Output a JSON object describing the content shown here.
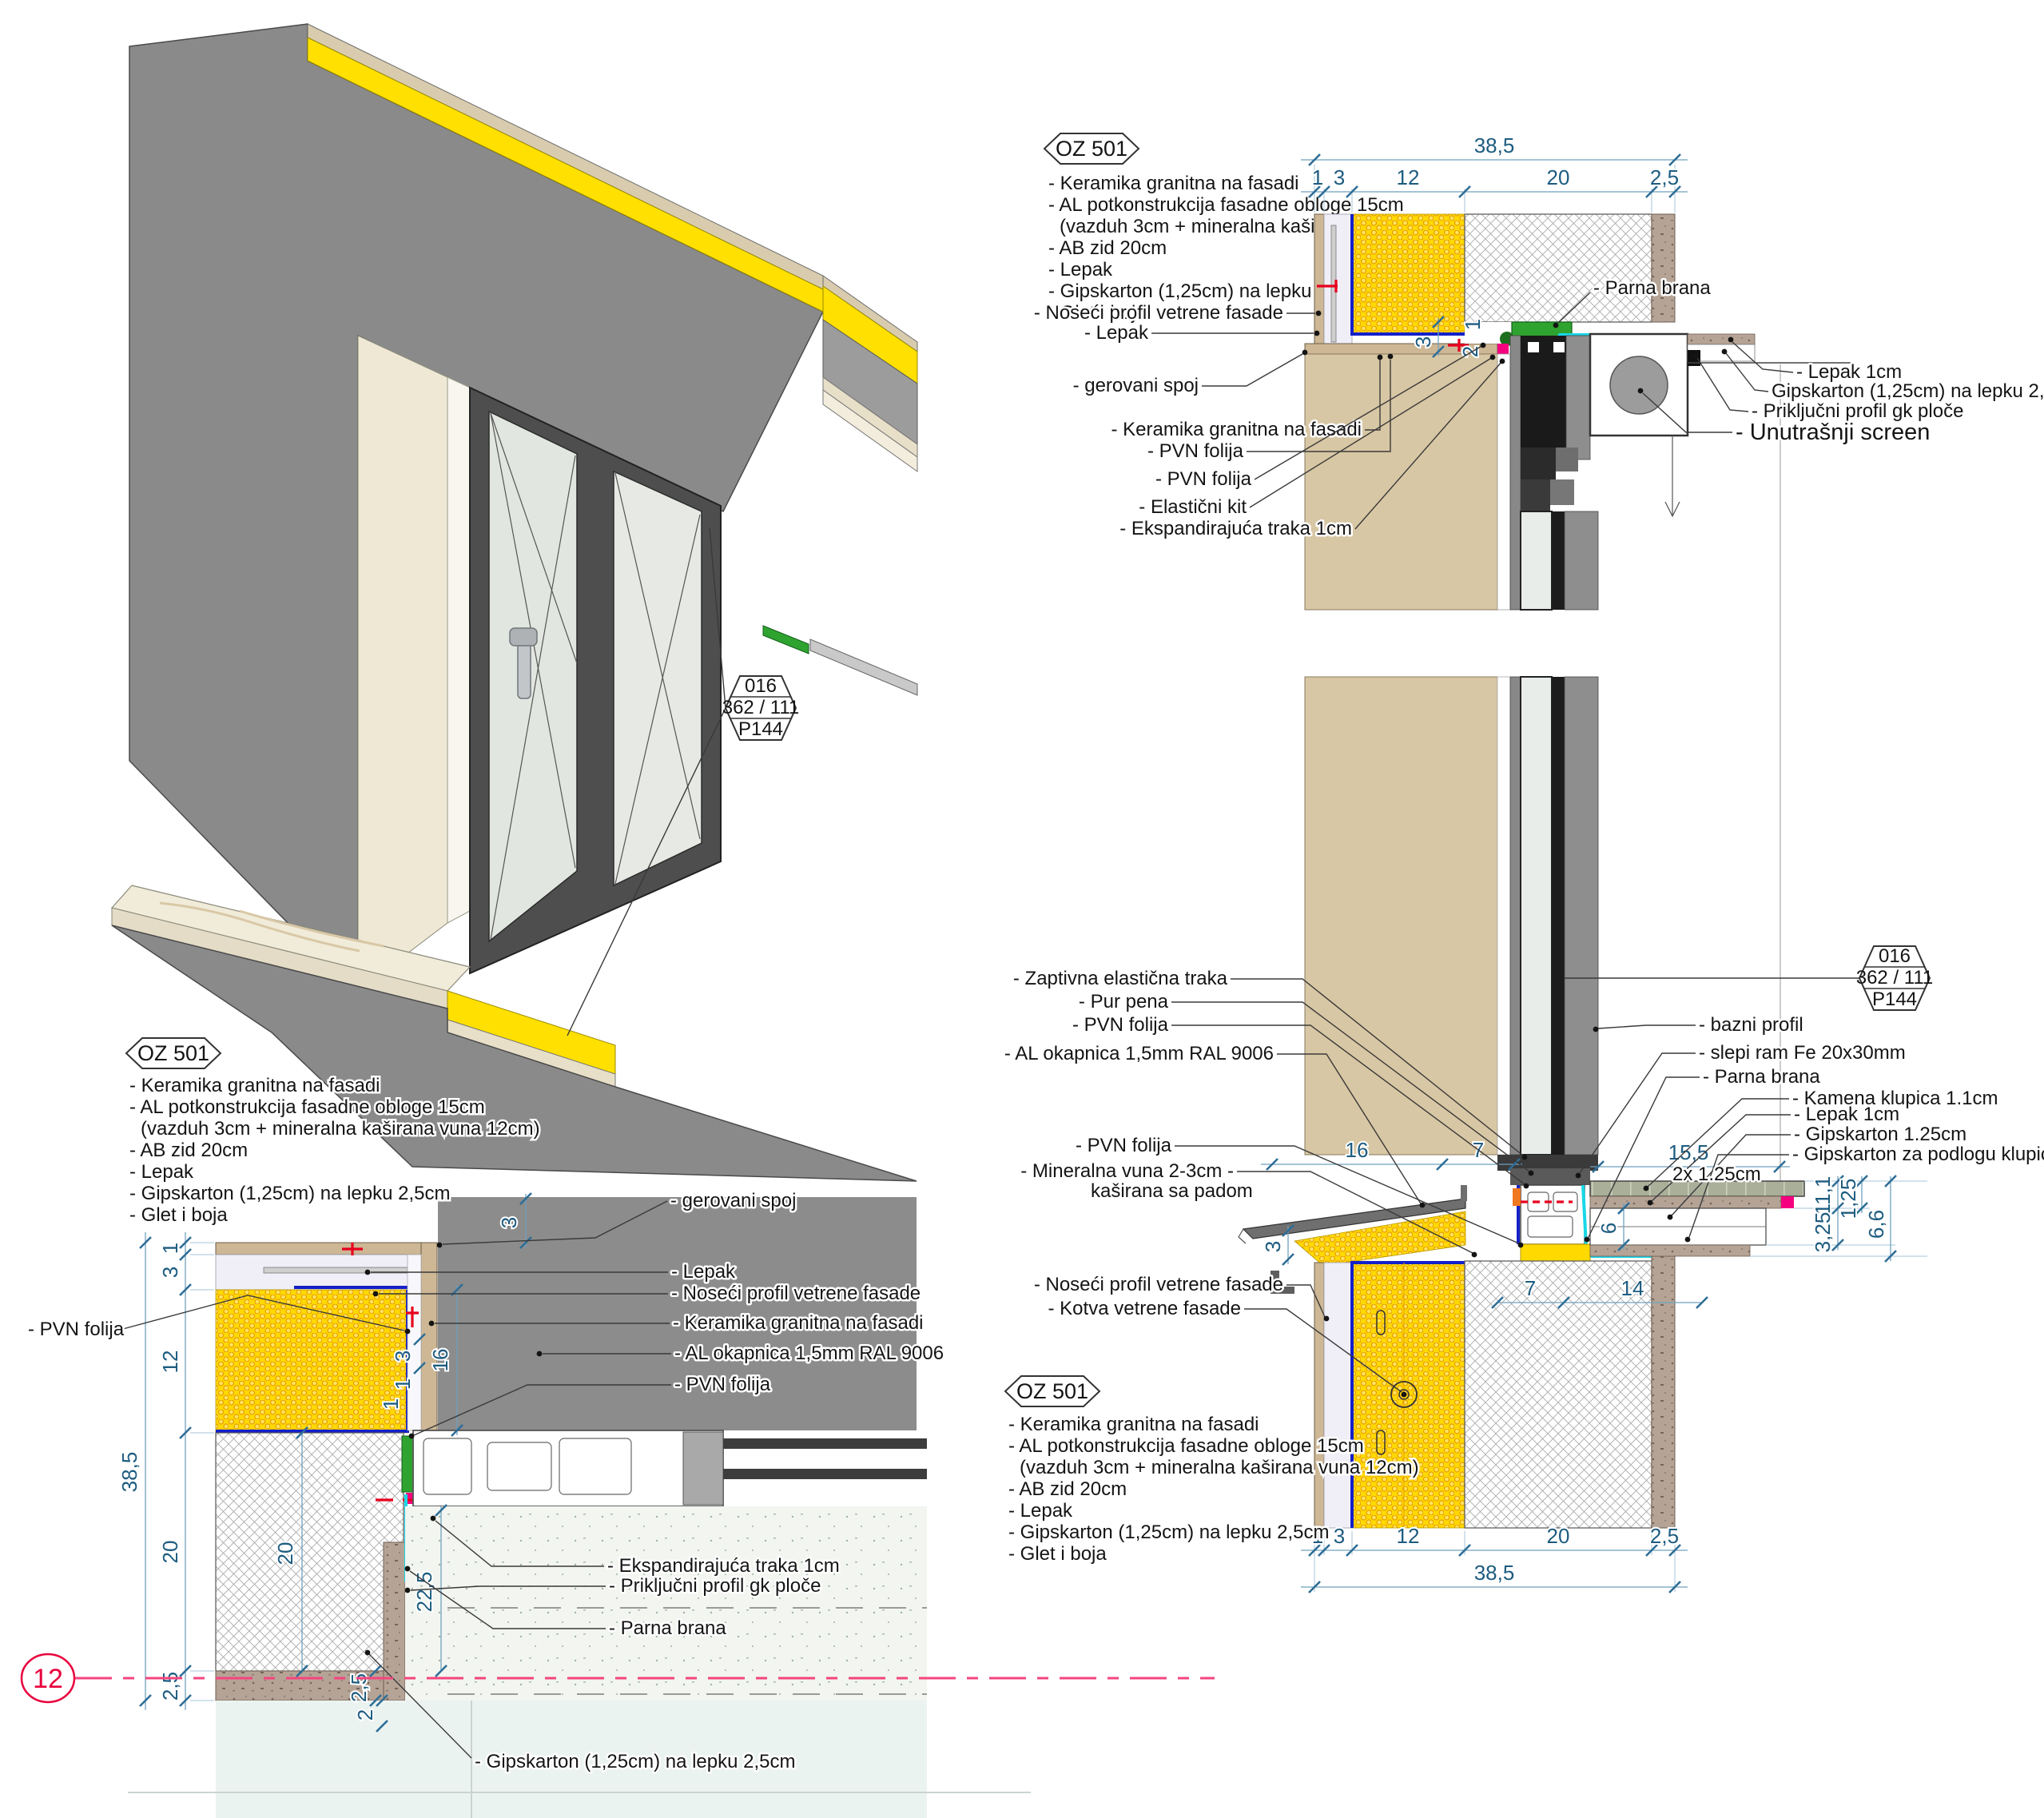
{
  "legend": {
    "code": "OZ 501",
    "items": [
      "- Keramika granitna na fasadi",
      "- AL potkonstrukcija fasadne obloge 15cm",
      "(vazduh 3cm + mineralna kaširana vuna 12cm)",
      "- AB zid 20cm",
      "- Lepak",
      "- Gipskarton (1,25cm) na lepku 2,5cm",
      "- Glet i boja"
    ]
  },
  "stamp": {
    "line1": "016",
    "line2": "362 / 111",
    "line3": "P144"
  },
  "axis": {
    "number": "12"
  },
  "head_detail": {
    "dims": {
      "total": "38,5",
      "seg1": "1",
      "seg2": "3",
      "seg3": "12",
      "seg4": "20",
      "seg5": "2,5",
      "small1": "3",
      "small2": "2",
      "small3": "1"
    },
    "labels": {
      "noseci": "- Noseći profil vetrene fasade",
      "lepak": "- Lepak",
      "gerovani": "- gerovani spoj",
      "keramika": "- Keramika granitna na fasadi",
      "pvn1": "- PVN folija",
      "pvn2": "- PVN folija",
      "elasticni": "- Elastični kit",
      "ekspand": "- Ekspandirajuća traka 1cm",
      "parna": "- Parna brana",
      "lepak1cm": "- Lepak 1cm",
      "gips": "Gipskarton (1,25cm) na lepku 2,5cm",
      "prikljucni": "- Priključni profil gk ploče",
      "screen": "- Unutrašnji screen"
    }
  },
  "sill_detail": {
    "dims": {
      "d16": "16",
      "d7a": "7",
      "d155": "15,5",
      "d6": "6",
      "d7b": "7",
      "d14": "14",
      "d111": "11,1",
      "d125": "1,25",
      "d66": "6,6",
      "d325": "3,25",
      "d3": "3",
      "total": "38,5",
      "seg1": "1",
      "seg2": "3",
      "seg3": "12",
      "seg4": "20",
      "seg5": "2,5"
    },
    "labels": {
      "zaptivna": "- Zaptivna elastična traka",
      "pur": "- Pur pena",
      "pvn1": "- PVN folija",
      "okapnica": "- AL okapnica 1,5mm RAL 9006",
      "pvn2": "- PVN folija",
      "mineralna1": "- Mineralna vuna 2-3cm -",
      "mineralna2": "kaširana sa padom",
      "noseci": "- Noseći profil vetrene fasade",
      "kotva": "- Kotva vetrene fasade",
      "bazni": "- bazni profil",
      "slepi": "- slepi ram Fe 20x30mm",
      "parna": "- Parna brana",
      "kamena": "- Kamena klupica 1.1cm",
      "lepak1cm": "- Lepak 1cm",
      "gips125": "- Gipskarton 1.25cm",
      "gipspod1": "- Gipskarton za podlogu klupice",
      "gipspod2": "2x 1.25cm"
    }
  },
  "corner_detail": {
    "dims": {
      "total": "38,5",
      "seg1": "1",
      "seg2": "3",
      "seg3": "12",
      "seg4": "20",
      "seg5": "2,5",
      "top3": "3",
      "d16": "16",
      "s3": "3",
      "s1a": "1",
      "s1b": "1",
      "d20": "20",
      "d225": "22,5",
      "d25": "2,5",
      "d2": "2"
    },
    "labels": {
      "pvn_left": "- PVN folija",
      "gerovani": "- gerovani spoj",
      "lepak": "- Lepak",
      "noseci": "- Noseći profil vetrene fasade",
      "keramika": "- Keramika granitna na fasadi",
      "okapnica": "- AL okapnica 1,5mm RAL 9006",
      "pvn": "- PVN folija",
      "ekspand": "- Ekspandirajuća traka 1cm",
      "prikljucni": "- Priključni profil gk ploče",
      "parna": "- Parna brana",
      "gips": "- Gipskarton (1,25cm) na lepku 2,5cm"
    }
  },
  "colors": {
    "insulation_yellow": "#FFD900",
    "facade_gray": "#8A8A8A",
    "ceramic_tan": "#CDB795",
    "pvn_blue": "#1420C8",
    "parna_cyan": "#17D8E8",
    "lepak_green": "#2FA32F",
    "accent_magenta": "#F5007E",
    "dim_blue": "#1D5C80",
    "axis_red": "#E8003C"
  }
}
